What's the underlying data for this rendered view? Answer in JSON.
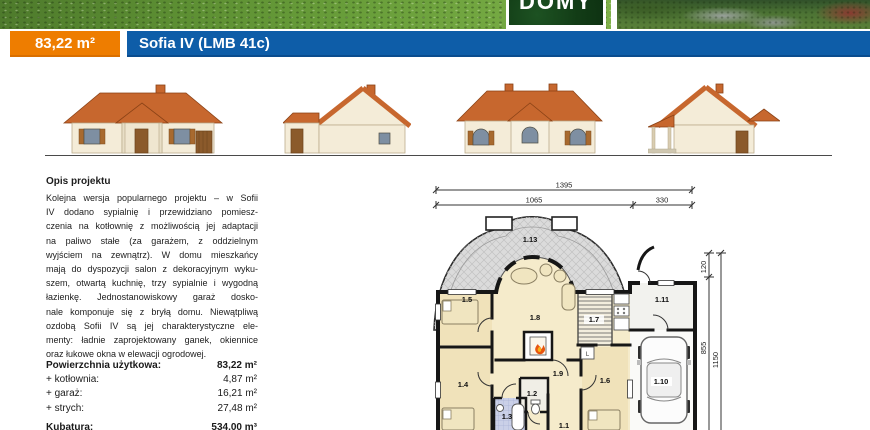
{
  "header": {
    "logo_text": "DOMY",
    "area_badge": "83,22 m²",
    "title": "Sofia IV (LMB 41c)"
  },
  "description": {
    "heading": "Opis projektu",
    "lines": [
      "Kolejna wersja popularnego projektu – w Sofii",
      "IV dodano sypialnię i przewidziano pomiesz-",
      "czenia na kotłownię z możliwością jej adaptacji",
      "na paliwo stałe (za garażem, z oddzielnym",
      "wyjściem na zewnątrz). W domu mieszkańcy",
      "mają do dyspozycji salon z dekoracyjnym wyku-",
      "szem, otwartą kuchnię, trzy sypialnie i wygodną",
      "łazienkę. Jednostanowiskowy garaż dosko-",
      "nale komponuje się z bryłą domu. Niewątpliwą",
      "ozdobą Sofii IV są jej charakterystyczne ele-",
      "menty: ładnie zaprojektowany ganek, okiennice",
      "oraz łukowe okna w elewacji ogrodowej."
    ]
  },
  "areas": {
    "rows": [
      {
        "label": "Powierzchnia użytkowa:",
        "value": "83,22 m²"
      },
      {
        "label": "+ kotłownia:",
        "value": "4,87 m²"
      },
      {
        "label": "+ garaż:",
        "value": "16,21 m²"
      },
      {
        "label": "+ strych:",
        "value": "27,48 m²"
      }
    ],
    "kubatura": {
      "label": "Kubatura:",
      "value": "534,00 m³"
    }
  },
  "floorplan": {
    "dims": {
      "total": "1395",
      "main": "1065",
      "garage": "330",
      "front": "120",
      "side": "855",
      "side_total": "1150"
    },
    "rooms": {
      "r1": "1.1",
      "r2": "1.2",
      "r3": "1.3",
      "r4": "1.4",
      "r5": "1.5",
      "r6": "1.6",
      "r7": "1.7",
      "r8": "1.8",
      "r9": "1.9",
      "r10": "1.10",
      "r11": "1.11",
      "r13": "1.13"
    },
    "fridge_label": "L"
  },
  "colors": {
    "accent_orange": "#EE7D00",
    "accent_blue": "#0E5DA8",
    "roof": "#C7672E",
    "logo_green": "#123C16",
    "plan_room": "#F5EBCB",
    "plan_bedroom": "#F0E2BA",
    "plan_terrace": "#DBDBDB",
    "plan_bath": "#CAD0E8",
    "wall": "#161616"
  }
}
